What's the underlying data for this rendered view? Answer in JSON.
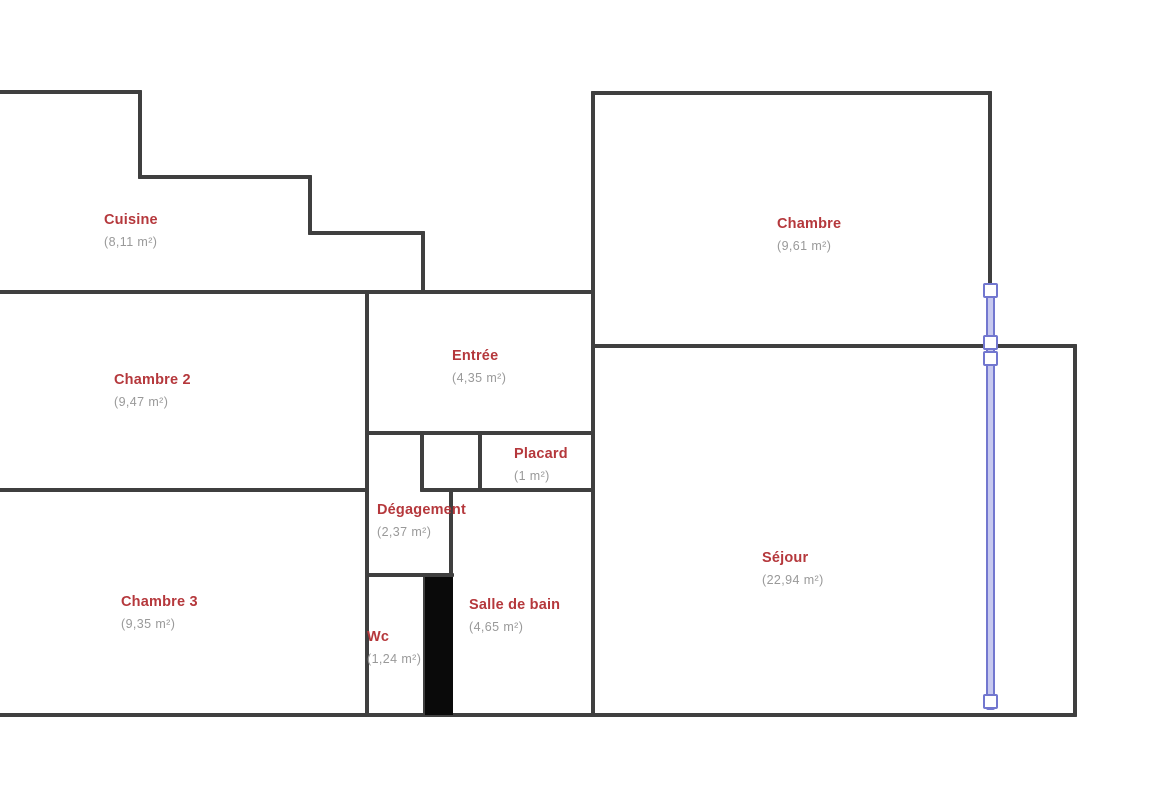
{
  "plan": {
    "title": "Floor plan with labeled rooms (French)",
    "background_color": "#ffffff",
    "wall_color": "#3f3f3f",
    "wall_thickness": 4,
    "room_name_color": "#b5383c",
    "room_area_color": "#999999",
    "rooms": [
      {
        "name": "Cuisine",
        "area": "(8,11 m²)",
        "x": 104,
        "y": 212
      },
      {
        "name": "Chambre",
        "area": "(9,61 m²)",
        "x": 777,
        "y": 216
      },
      {
        "name": "Chambre 2",
        "area": "(9,47 m²)",
        "x": 114,
        "y": 372
      },
      {
        "name": "Entrée",
        "area": "(4,35 m²)",
        "x": 452,
        "y": 348
      },
      {
        "name": "Placard",
        "area": "(1 m²)",
        "x": 514,
        "y": 446
      },
      {
        "name": "Dégagement",
        "area": "(2,37 m²)",
        "x": 377,
        "y": 502
      },
      {
        "name": "Chambre 3",
        "area": "(9,35 m²)",
        "x": 121,
        "y": 594
      },
      {
        "name": "Wc",
        "area": "(1,24 m²)",
        "x": 367,
        "y": 629
      },
      {
        "name": "Salle de bain",
        "area": "(4,65 m²)",
        "x": 469,
        "y": 597
      },
      {
        "name": "Séjour",
        "area": "(22,94 m²)",
        "x": 762,
        "y": 550
      }
    ],
    "walls": [
      [
        0,
        92,
        140,
        92
      ],
      [
        140,
        92,
        140,
        177
      ],
      [
        140,
        177,
        310,
        177
      ],
      [
        310,
        177,
        310,
        233
      ],
      [
        310,
        233,
        423,
        233
      ],
      [
        423,
        233,
        423,
        292
      ],
      [
        0,
        292,
        593,
        292
      ],
      [
        593,
        93,
        990,
        93
      ],
      [
        593,
        93,
        593,
        715
      ],
      [
        990,
        93,
        990,
        346
      ],
      [
        593,
        346,
        1075,
        346
      ],
      [
        1075,
        346,
        1075,
        715
      ],
      [
        367,
        292,
        367,
        715
      ],
      [
        367,
        433,
        593,
        433
      ],
      [
        422,
        433,
        422,
        490
      ],
      [
        480,
        433,
        480,
        490
      ],
      [
        0,
        490,
        367,
        490
      ],
      [
        422,
        490,
        593,
        490
      ],
      [
        451,
        490,
        451,
        578
      ],
      [
        367,
        575,
        452,
        575
      ],
      [
        425,
        575,
        425,
        715
      ],
      [
        0,
        715,
        1075,
        715
      ]
    ],
    "solid_block": {
      "x": 425,
      "y": 577,
      "w": 28,
      "h": 138
    },
    "selection": {
      "line_color": "#7277cf",
      "line_fill": "#c7c9ef",
      "handle_fill": "#ffffff",
      "x": 990,
      "y1": 283,
      "y2": 710,
      "line_width": 9,
      "handle_size": 15,
      "handles_y": [
        290,
        342,
        358,
        701
      ]
    }
  }
}
